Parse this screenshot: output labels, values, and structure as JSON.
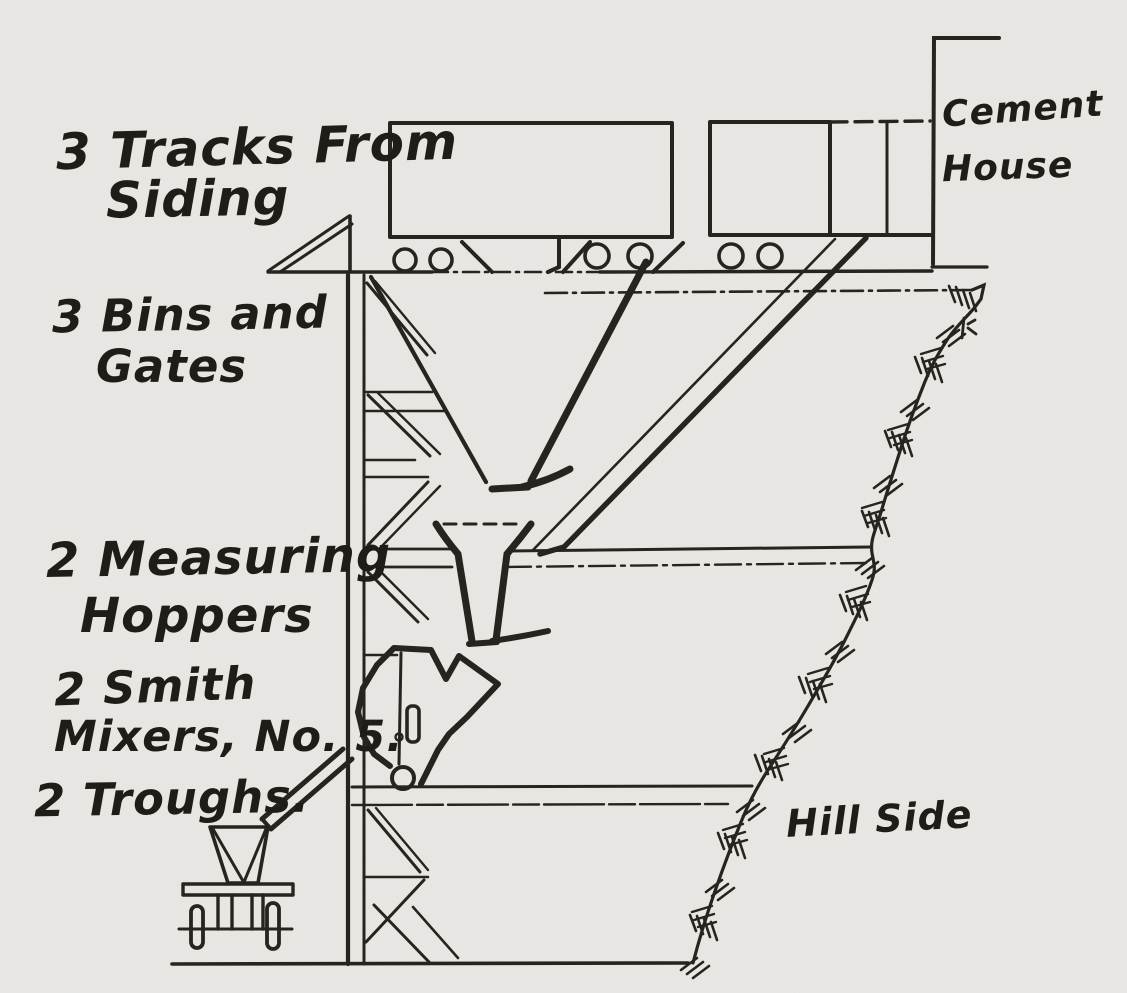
{
  "document_kind": "scanned hand-drawn engineering diagram of a hillside concrete mixing plant",
  "colors": {
    "ink": "#221e19",
    "paper": "#e9e8e4"
  },
  "annotations": {
    "tracks": {
      "line1": "3 Tracks From",
      "line2": "Siding"
    },
    "bins": {
      "line1": "3 Bins and",
      "line2": "Gates"
    },
    "hoppers": {
      "line1": "2 Measuring",
      "line2": "Hoppers"
    },
    "mixers": {
      "line1": "2 Smith",
      "line2": "Mixers, No. 5."
    },
    "troughs": {
      "line1": "2 Troughs."
    },
    "cement_house": {
      "line1": "Cement",
      "line2": "House"
    },
    "hillside": {
      "line1": "Hill Side"
    }
  },
  "diagram": {
    "parts": [
      "rail-car",
      "rail-car-partial",
      "car-wheels",
      "track-platform",
      "a-frame-ramp",
      "timber-tower",
      "storage-bin-funnel",
      "inclined-chute",
      "measuring-hopper-funnel",
      "smith-mixer",
      "discharge-trough",
      "concrete-cart",
      "cement-house-wall",
      "hillside-cut",
      "ground-line"
    ]
  }
}
